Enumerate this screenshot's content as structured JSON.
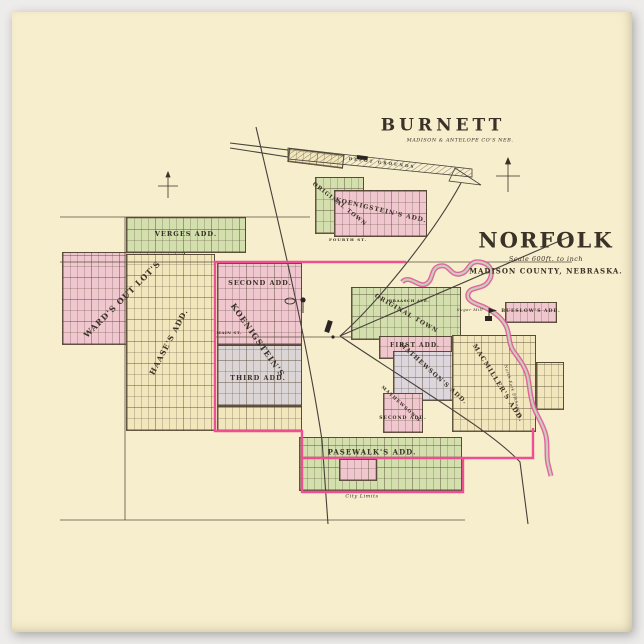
{
  "burnett": {
    "title": "BURNETT",
    "subtitle": "MADISON & ANTELOPE CO'S NEB.",
    "original_town": "ORIGINAL TOWN",
    "koenigstein": "KOENIGSTEIN'S ADD.",
    "fourth_st": "FOURTH ST.",
    "depot": "DEPOT GROUNDS"
  },
  "norfolk": {
    "title": "NORFOLK",
    "scale": "Scale 600ft. to inch",
    "county": "MADISON COUNTY, NEBRASKA.",
    "additions": {
      "verges": "VERGES ADD.",
      "wards": "WARD'S OUT LOT'S",
      "haases": "HAASE'S ADD.",
      "second": "SECOND ADD.",
      "koenigstein": "KOENIGSTEIN'S",
      "third": "THIRD ADD.",
      "original_town": "ORIGINAL TOWN",
      "first": "FIRST ADD.",
      "mathewsons": "MATHEWSON'S ADD.",
      "mathewsons_second_1": "MATHEWSON'S",
      "mathewsons_second_2": "SECOND ADD.",
      "macmillers": "MACMILLER'S ADD.",
      "bueslows": "BUESLOW'S ADD.",
      "pasewalks": "PASEWALK'S ADD."
    },
    "streets": {
      "main": "MAIN ST.",
      "braasch": "BRAASCH AVE."
    },
    "annotations": {
      "city_limits": "City Limits",
      "sugar_mill": "Sugar Mill",
      "river": "North Fork Elkhorn R."
    }
  },
  "colors": {
    "paper": "#f6eecd",
    "boundary_pink": "#ee4f92",
    "block_green": "#d4dfae",
    "block_pink": "#f0c7ce",
    "block_gray": "#dbd5d6",
    "ink": "#3a3127"
  }
}
